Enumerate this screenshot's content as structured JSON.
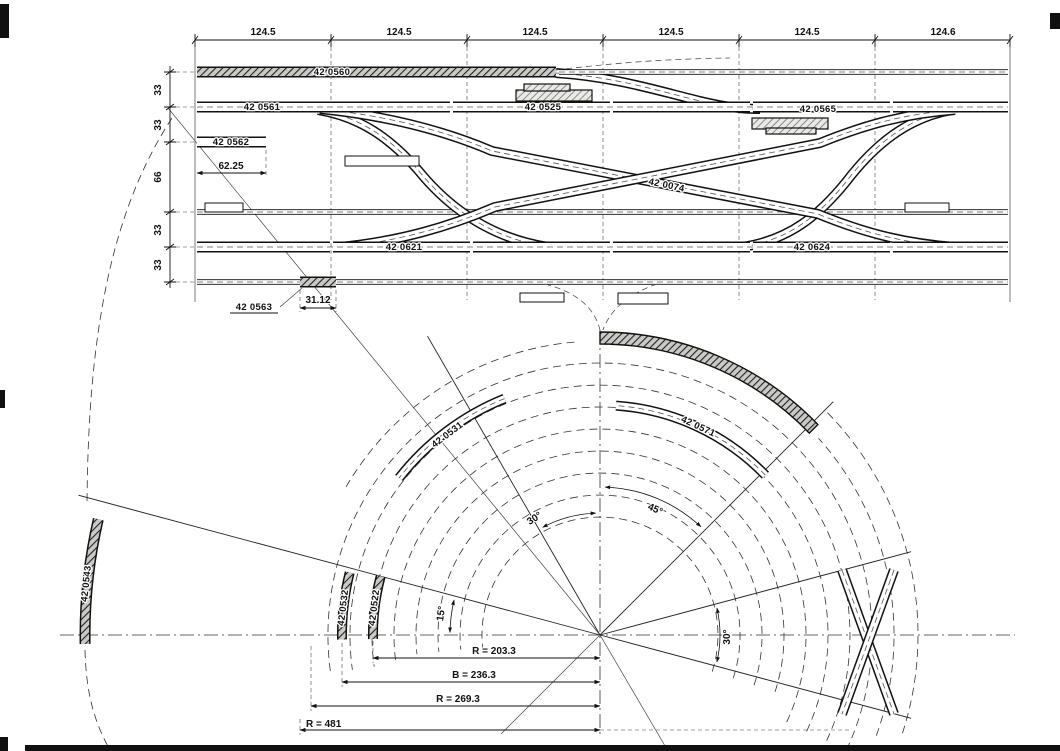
{
  "drawing": {
    "top_dims": [
      "124.5",
      "124.5",
      "124.5",
      "124.5",
      "124.5",
      "124.6"
    ],
    "left_dims": [
      "33",
      "33",
      "66",
      "33",
      "33"
    ],
    "parts": {
      "p560": "42 0560",
      "p561": "42 0561",
      "p525": "42 0525",
      "p565": "42 0565",
      "p562": "42 0562",
      "p074": "42 0074",
      "p621": "42 0621",
      "p624": "42 0624",
      "p563": "42 0563",
      "p531": "42 0531",
      "p571": "42 0571",
      "p543": "42 0543",
      "p532": "42 0532",
      "p522": "42 0522"
    },
    "dims": {
      "d6225": "62.25",
      "d3112": "31.12"
    },
    "angles": {
      "left30": "30°",
      "a45": "45°",
      "a15": "15°",
      "right30": "30°"
    },
    "radii": {
      "r203": "R = 203.3",
      "r236": "B = 236.3",
      "r269": "R = 269.3",
      "r481": "R = 481"
    }
  }
}
